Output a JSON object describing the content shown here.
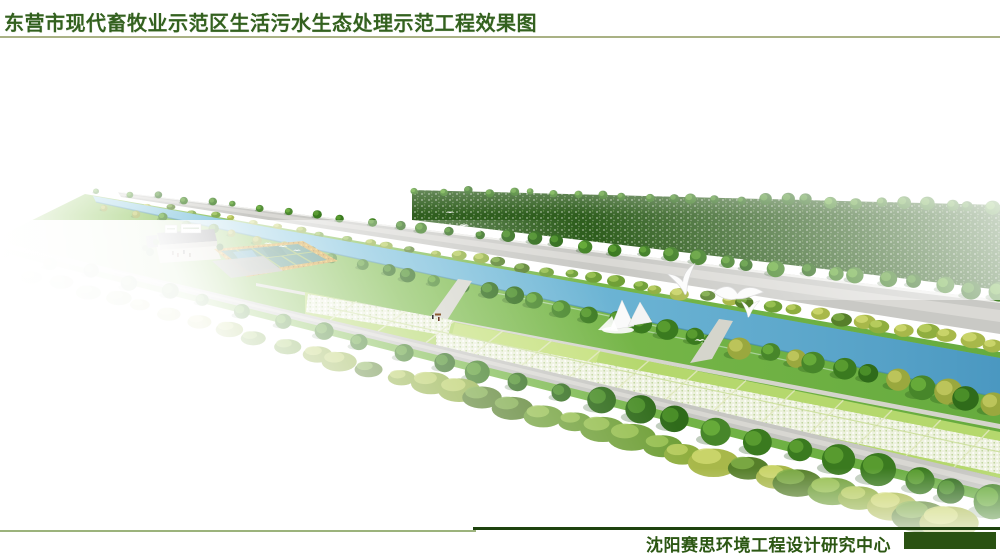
{
  "header": {
    "title": "东营市现代畜牧业示范区生活污水生态处理示范工程效果图"
  },
  "footer": {
    "credit": "沈阳赛思环境工程设计研究中心"
  },
  "theme": {
    "page-bg": "#ffffff",
    "title-green": "#33611f",
    "rule-olive": "#a9b184",
    "rule-light-olive": "#9cb37c",
    "rule-dark": "#1e430e",
    "credit-green": "#2c5713",
    "block-green": "#2a5212"
  },
  "scene": {
    "canal_color": "#6db6d8",
    "road_color": "#c9c9c5",
    "near_road_color": "#c6c6c2",
    "forest_color": "#2f5e1e",
    "lawn_color": "#7cba4c",
    "field_color": "#b5d86d",
    "flower_field_color": "#edf1de",
    "pond_color": "#48897b",
    "flower_border_color": "#cf9a2e",
    "basin_color": "#a8aca4",
    "courtyard_color": "#d9d6c6",
    "roof_color": "#55555a",
    "bird_color": "#ffffff"
  }
}
